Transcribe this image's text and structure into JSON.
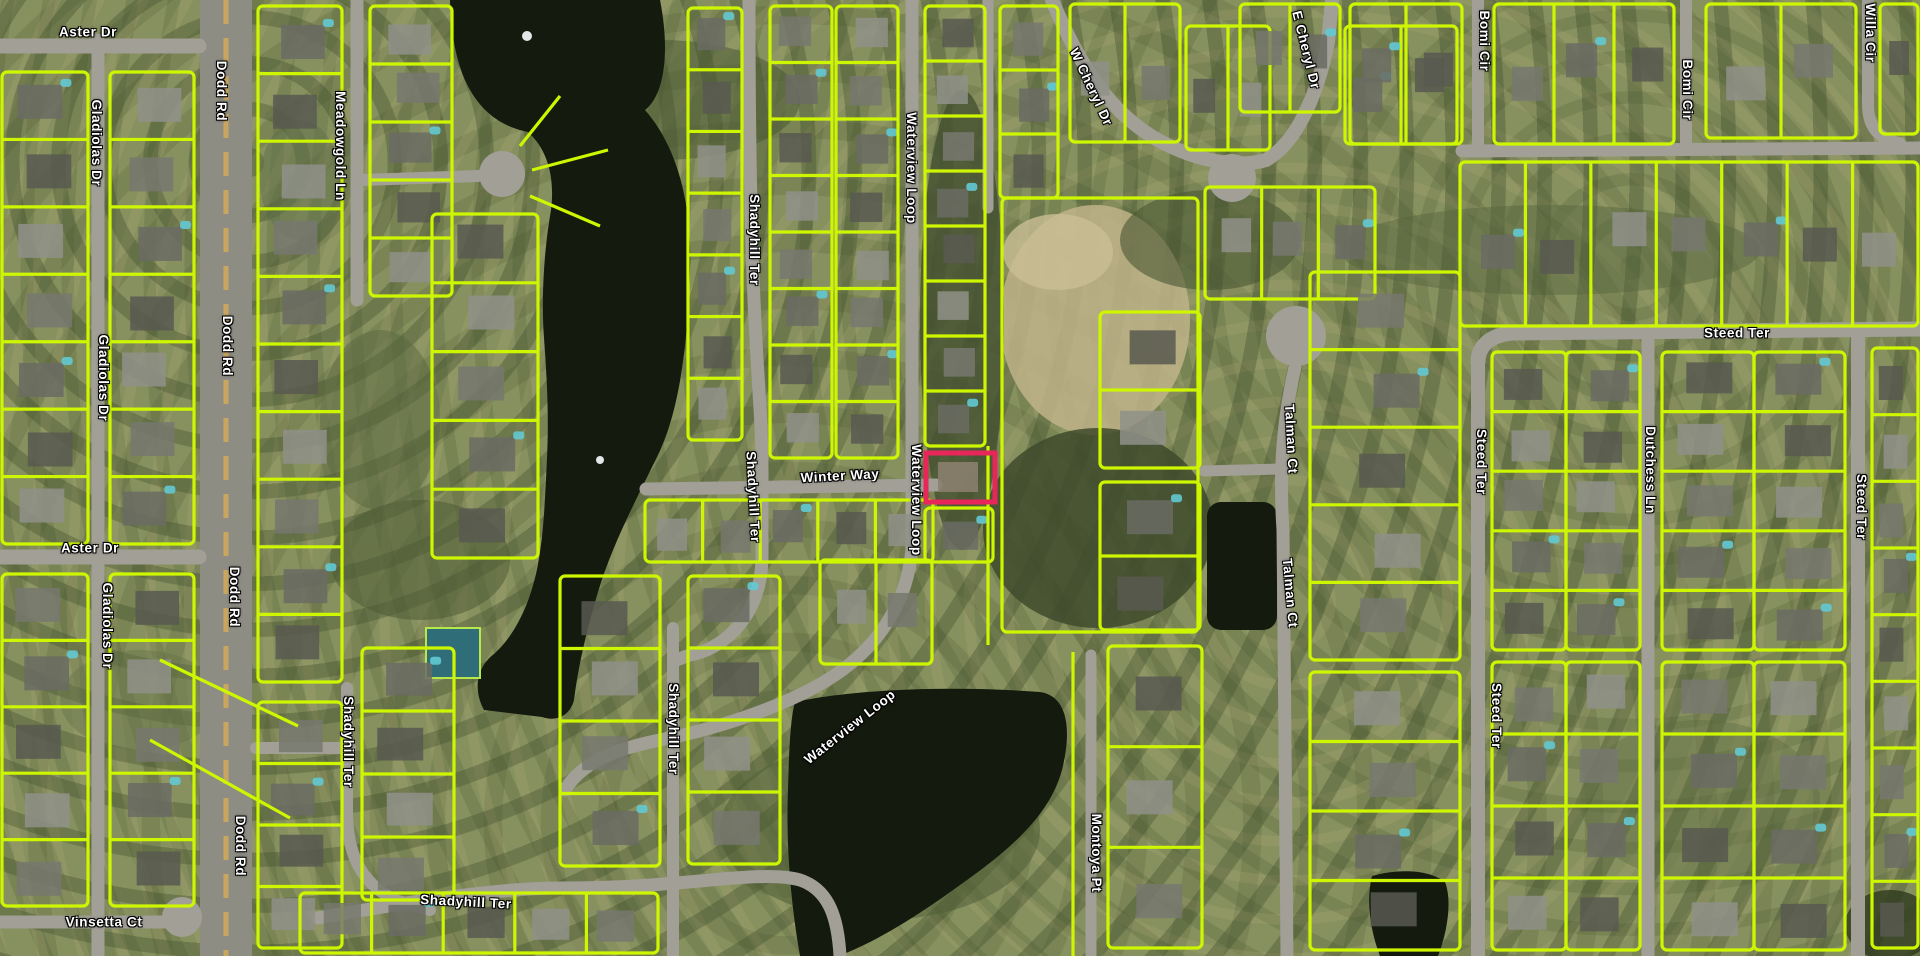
{
  "app": {
    "type": "gis-parcel-map-viewer",
    "view": "aerial-with-parcels"
  },
  "map": {
    "width": 1920,
    "height": 956,
    "colors": {
      "parcel_line": "#cdf600",
      "highlight": "#e8265a",
      "label_text": "#ffffff",
      "label_halo": "#000000",
      "road": "#a19f96",
      "road_major": "#8e8d84",
      "road_median": "#c9a660",
      "water": "#141a0e",
      "ground": "#87915f",
      "tennis_court": "#2f6e78",
      "fountain": "#eef2f2"
    },
    "highlight_parcel": {
      "x": 926,
      "y": 453,
      "w": 69,
      "h": 49,
      "stroke_width": 5
    },
    "street_labels": [
      {
        "t": "Aster Dr",
        "x": 88,
        "y": 32,
        "r": 0
      },
      {
        "t": "Gladiolas Dr",
        "x": 96,
        "y": 143,
        "r": 90
      },
      {
        "t": "Dodd Rd",
        "x": 221,
        "y": 91,
        "r": 90
      },
      {
        "t": "Meadowgold Ln",
        "x": 340,
        "y": 146,
        "r": 90
      },
      {
        "t": "Shadyhill Ter",
        "x": 754,
        "y": 240,
        "r": 90
      },
      {
        "t": "Waterview Loop",
        "x": 911,
        "y": 168,
        "r": 90
      },
      {
        "t": "W Cheryl Dr",
        "x": 1091,
        "y": 87,
        "r": 65
      },
      {
        "t": "E Cheryl Dr",
        "x": 1306,
        "y": 50,
        "r": 76
      },
      {
        "t": "Bomi Cir",
        "x": 1484,
        "y": 41,
        "r": 90
      },
      {
        "t": "Bomi Cir",
        "x": 1687,
        "y": 90,
        "r": 90
      },
      {
        "t": "Willa Cir",
        "x": 1870,
        "y": 33,
        "r": 90
      },
      {
        "t": "Steed Ter",
        "x": 1737,
        "y": 333,
        "r": 0
      },
      {
        "t": "Steed Ter",
        "x": 1481,
        "y": 462,
        "r": 90
      },
      {
        "t": "Dutchess Ln",
        "x": 1650,
        "y": 470,
        "r": 90
      },
      {
        "t": "Steed Ter",
        "x": 1861,
        "y": 507,
        "r": 90
      },
      {
        "t": "Winter Way",
        "x": 840,
        "y": 476,
        "r": -3
      },
      {
        "t": "Waterview Loop",
        "x": 916,
        "y": 500,
        "r": 90
      },
      {
        "t": "Shadyhill Ter",
        "x": 753,
        "y": 497,
        "r": 87
      },
      {
        "t": "Shadyhill Ter",
        "x": 673,
        "y": 729,
        "r": 90
      },
      {
        "t": "Shadyhill Ter",
        "x": 466,
        "y": 902,
        "r": 3
      },
      {
        "t": "Vinsetta Ct",
        "x": 104,
        "y": 922,
        "r": 0
      },
      {
        "t": "Dodd Rd",
        "x": 227,
        "y": 346,
        "r": 90
      },
      {
        "t": "Dodd Rd",
        "x": 234,
        "y": 597,
        "r": 90
      },
      {
        "t": "Dodd Rd",
        "x": 240,
        "y": 846,
        "r": 90
      },
      {
        "t": "Gladiolas Dr",
        "x": 103,
        "y": 378,
        "r": 90
      },
      {
        "t": "Gladiolas Dr",
        "x": 107,
        "y": 626,
        "r": 90
      },
      {
        "t": "Aster Dr",
        "x": 90,
        "y": 548,
        "r": 0
      },
      {
        "t": "Waterview Loop",
        "x": 850,
        "y": 727,
        "r": -38
      },
      {
        "t": "Montoya Pt",
        "x": 1096,
        "y": 853,
        "r": 90
      },
      {
        "t": "Talman Ct",
        "x": 1291,
        "y": 439,
        "r": 87
      },
      {
        "t": "Talman Ct",
        "x": 1290,
        "y": 593,
        "r": 85
      },
      {
        "t": "Steed Ter",
        "x": 1496,
        "y": 716,
        "r": 90
      },
      {
        "t": "Shadyhill Ter",
        "x": 348,
        "y": 742,
        "r": 90
      }
    ],
    "roads": [
      {
        "name": "dodd-rd",
        "d": "M226,0 L226,956",
        "w": 52,
        "major": true
      },
      {
        "name": "gladiolas-dr",
        "d": "M98,40 L98,956",
        "w": 13
      },
      {
        "name": "aster-dr-top",
        "d": "M0,46 L199,46",
        "w": 15
      },
      {
        "name": "aster-dr-mid",
        "d": "M0,557 L199,557",
        "w": 15
      },
      {
        "name": "vinsetta-ct",
        "d": "M0,922 L172,922",
        "w": 13
      },
      {
        "name": "meadowgold-ln",
        "d": "M357,0 L357,300",
        "w": 13
      },
      {
        "name": "meadowgold-spur",
        "d": "M362,180 L478,176",
        "w": 12
      },
      {
        "name": "shadyhill-ter-upper",
        "d": "M749,0 C749,350 762,380 762,470 L762,560 C760,620 720,650 690,655 L676,660",
        "w": 13
      },
      {
        "name": "shadyhill-ter-bottom-v",
        "d": "M673,628 L673,956",
        "w": 12
      },
      {
        "name": "shadyhill-ter-bottom-h",
        "d": "M318,918 C420,900 500,888 560,888 C620,888 650,885 675,883 C720,880 770,872 800,880 C830,890 838,920 840,956",
        "w": 13
      },
      {
        "name": "shadyhill-ter-east",
        "d": "M347,688 L347,810 C347,860 365,885 395,900 L430,910",
        "w": 12
      },
      {
        "name": "dodd-cross-east",
        "d": "M256,748 L350,748",
        "w": 12
      },
      {
        "name": "waterview-loop-top",
        "d": "M912,0 L912,548",
        "w": 13
      },
      {
        "name": "waterview-loop-arc",
        "d": "M912,548 C908,600 880,645 835,675 C790,705 720,728 660,740 C610,750 580,765 565,790",
        "w": 13
      },
      {
        "name": "winter-way",
        "d": "M646,489 L936,485",
        "w": 13
      },
      {
        "name": "w-cheryl-dr",
        "d": "M1052,0 C1078,62 1108,112 1158,140 C1198,162 1238,168 1266,160",
        "w": 14
      },
      {
        "name": "e-cheryl-dr",
        "d": "M1266,160 C1298,142 1318,92 1328,42 L1332,0",
        "w": 14
      },
      {
        "name": "steed-ter-h",
        "d": "M1478,362 C1478,345 1492,334 1515,333 L1920,329",
        "w": 15
      },
      {
        "name": "steed-ter-v",
        "d": "M1478,362 L1478,956",
        "w": 14
      },
      {
        "name": "dutchess-ln",
        "d": "M1648,341 L1648,956",
        "w": 13
      },
      {
        "name": "steed-ter-right",
        "d": "M1858,331 L1858,956",
        "w": 14
      },
      {
        "name": "bomi-cir-h",
        "d": "M1462,151 L1920,148",
        "w": 13
      },
      {
        "name": "bomi-cir-v1",
        "d": "M1478,0 L1478,145",
        "w": 12
      },
      {
        "name": "bomi-cir-v2",
        "d": "M1686,0 L1686,145",
        "w": 12
      },
      {
        "name": "willa-cir",
        "d": "M1868,0 L1868,105 C1868,128 1880,140 1900,143",
        "w": 12
      },
      {
        "name": "talman-ct",
        "d": "M1295,367 C1283,420 1279,470 1283,530 L1287,956",
        "w": 13
      },
      {
        "name": "talman-ct-spur",
        "d": "M1204,471 L1281,469",
        "w": 11
      },
      {
        "name": "montoya-pt",
        "d": "M1091,655 L1091,956",
        "w": 11
      },
      {
        "name": "north-street",
        "d": "M988,0 L988,208",
        "w": 11
      }
    ],
    "culdesac_bulbs": [
      {
        "cx": 182,
        "cy": 917,
        "r": 20
      },
      {
        "cx": 502,
        "cy": 174,
        "r": 23
      },
      {
        "cx": 1296,
        "cy": 336,
        "r": 30
      },
      {
        "cx": 1232,
        "cy": 178,
        "r": 24
      }
    ],
    "water": [
      {
        "name": "lake",
        "d": "M450,0 L660,0 C670,50 665,95 645,110 C680,150 692,210 690,270 C688,340 680,410 658,455 C636,500 612,545 598,592 C586,632 578,668 574,700 C570,716 556,722 542,717 L484,710 C472,688 478,666 494,654 C514,636 528,608 536,574 C544,538 545,498 547,458 C549,418 547,378 544,338 C541,298 544,250 551,210 C555,178 548,150 528,132 C478,122 452,78 450,0 Z"
      },
      {
        "name": "pond-center",
        "d": "M795,702 C860,688 960,686 1040,692 C1068,696 1072,730 1062,770 C1050,815 1010,850 960,885 C915,918 870,945 838,956 L800,956 C790,900 786,840 788,790 C789,755 790,720 795,702 Z"
      },
      {
        "name": "pond-bottom-right",
        "d": "M1372,876 C1400,868 1430,870 1445,882 C1452,900 1448,930 1438,956 L1380,956 C1370,930 1366,900 1372,876 Z"
      }
    ],
    "pond_rect": {
      "x": 1207,
      "y": 502,
      "w": 70,
      "h": 128,
      "rx": 14
    },
    "terrain_patches": [
      {
        "cx": 1095,
        "cy": 320,
        "rx": 95,
        "ry": 115,
        "f": "#c0b389",
        "o": 0.85
      },
      {
        "cx": 1058,
        "cy": 252,
        "rx": 55,
        "ry": 38,
        "f": "#cabe95",
        "o": 0.8
      },
      {
        "cx": 1098,
        "cy": 528,
        "rx": 115,
        "ry": 100,
        "f": "#3e4a2b",
        "o": 0.85
      },
      {
        "cx": 962,
        "cy": 320,
        "rx": 42,
        "ry": 230,
        "f": "#435030",
        "o": 0.8
      },
      {
        "cx": 1210,
        "cy": 240,
        "rx": 90,
        "ry": 50,
        "f": "#4a5732",
        "o": 0.6
      },
      {
        "cx": 660,
        "cy": 100,
        "rx": 140,
        "ry": 60,
        "f": "#46532f",
        "o": 0.5
      },
      {
        "cx": 420,
        "cy": 560,
        "rx": 90,
        "ry": 60,
        "f": "#4e5b34",
        "o": 0.55
      },
      {
        "cx": 880,
        "cy": 830,
        "rx": 160,
        "ry": 90,
        "f": "#515f37",
        "o": 0.55
      },
      {
        "cx": 1550,
        "cy": 250,
        "rx": 210,
        "ry": 45,
        "f": "#55633c",
        "o": 0.45
      },
      {
        "cx": 380,
        "cy": 420,
        "rx": 60,
        "ry": 90,
        "f": "#5a6840",
        "o": 0.5
      },
      {
        "cx": 1890,
        "cy": 925,
        "rx": 45,
        "ry": 35,
        "f": "#2e3a1e",
        "o": 0.8
      },
      {
        "cx": 300,
        "cy": 180,
        "rx": 40,
        "ry": 60,
        "f": "#60704a",
        "o": 0.5
      },
      {
        "cx": 1700,
        "cy": 800,
        "rx": 120,
        "ry": 80,
        "f": "#5d6b41",
        "o": 0.4
      },
      {
        "cx": 140,
        "cy": 700,
        "rx": 80,
        "ry": 50,
        "f": "#66744a",
        "o": 0.45
      }
    ],
    "parcel_strips": [
      {
        "x": 2,
        "y": 72,
        "w": 86,
        "h": 472,
        "n": 7,
        "dir": "h"
      },
      {
        "x": 2,
        "y": 574,
        "w": 86,
        "h": 332,
        "n": 5,
        "dir": "h"
      },
      {
        "x": 110,
        "y": 72,
        "w": 84,
        "h": 472,
        "n": 7,
        "dir": "h"
      },
      {
        "x": 110,
        "y": 574,
        "w": 84,
        "h": 332,
        "n": 5,
        "dir": "h"
      },
      {
        "x": 258,
        "y": 6,
        "w": 84,
        "h": 676,
        "n": 10,
        "dir": "h"
      },
      {
        "x": 258,
        "y": 702,
        "w": 84,
        "h": 246,
        "n": 4,
        "dir": "h"
      },
      {
        "x": 370,
        "y": 6,
        "w": 82,
        "h": 290,
        "n": 5,
        "dir": "h"
      },
      {
        "x": 432,
        "y": 214,
        "w": 106,
        "h": 344,
        "n": 5,
        "dir": "h"
      },
      {
        "x": 688,
        "y": 8,
        "w": 54,
        "h": 432,
        "n": 7,
        "dir": "h"
      },
      {
        "x": 770,
        "y": 6,
        "w": 62,
        "h": 452,
        "n": 8,
        "dir": "h"
      },
      {
        "x": 836,
        "y": 6,
        "w": 62,
        "h": 452,
        "n": 8,
        "dir": "h"
      },
      {
        "x": 925,
        "y": 6,
        "w": 60,
        "h": 440,
        "n": 8,
        "dir": "h"
      },
      {
        "x": 925,
        "y": 508,
        "w": 68,
        "h": 54,
        "n": 1,
        "dir": "h"
      },
      {
        "x": 1002,
        "y": 198,
        "w": 196,
        "h": 434,
        "n": 1,
        "dir": "h",
        "nh": 1
      },
      {
        "x": 645,
        "y": 500,
        "w": 288,
        "h": 62,
        "n": 5,
        "dir": "v"
      },
      {
        "x": 560,
        "y": 576,
        "w": 100,
        "h": 290,
        "n": 4,
        "dir": "h"
      },
      {
        "x": 688,
        "y": 576,
        "w": 92,
        "h": 288,
        "n": 4,
        "dir": "h"
      },
      {
        "x": 300,
        "y": 893,
        "w": 358,
        "h": 60,
        "n": 5,
        "dir": "v"
      },
      {
        "x": 820,
        "y": 560,
        "w": 112,
        "h": 104,
        "n": 2,
        "dir": "v"
      },
      {
        "x": 1108,
        "y": 646,
        "w": 94,
        "h": 302,
        "n": 3,
        "dir": "h"
      },
      {
        "x": 362,
        "y": 648,
        "w": 92,
        "h": 252,
        "n": 4,
        "dir": "h"
      },
      {
        "x": 1000,
        "y": 6,
        "w": 58,
        "h": 192,
        "n": 3,
        "dir": "h"
      },
      {
        "x": 1070,
        "y": 4,
        "w": 110,
        "h": 138,
        "n": 2,
        "dir": "v"
      },
      {
        "x": 1186,
        "y": 26,
        "w": 84,
        "h": 124,
        "n": 2,
        "dir": "v"
      },
      {
        "x": 1345,
        "y": 26,
        "w": 112,
        "h": 118,
        "n": 2,
        "dir": "v"
      },
      {
        "x": 1240,
        "y": 4,
        "w": 100,
        "h": 108,
        "n": 2,
        "dir": "v"
      },
      {
        "x": 1205,
        "y": 187,
        "w": 170,
        "h": 112,
        "n": 3,
        "dir": "v"
      },
      {
        "x": 1100,
        "y": 312,
        "w": 100,
        "h": 156,
        "n": 2,
        "dir": "h"
      },
      {
        "x": 1100,
        "y": 482,
        "w": 100,
        "h": 148,
        "n": 2,
        "dir": "h"
      },
      {
        "x": 1310,
        "y": 272,
        "w": 150,
        "h": 388,
        "n": 5,
        "dir": "h"
      },
      {
        "x": 1310,
        "y": 672,
        "w": 150,
        "h": 278,
        "n": 4,
        "dir": "h"
      },
      {
        "x": 1492,
        "y": 352,
        "w": 74,
        "h": 298,
        "n": 5,
        "dir": "h"
      },
      {
        "x": 1566,
        "y": 352,
        "w": 74,
        "h": 298,
        "n": 5,
        "dir": "h"
      },
      {
        "x": 1492,
        "y": 662,
        "w": 74,
        "h": 288,
        "n": 4,
        "dir": "h"
      },
      {
        "x": 1566,
        "y": 662,
        "w": 74,
        "h": 288,
        "n": 4,
        "dir": "h"
      },
      {
        "x": 1662,
        "y": 352,
        "w": 92,
        "h": 298,
        "n": 5,
        "dir": "h"
      },
      {
        "x": 1754,
        "y": 352,
        "w": 91,
        "h": 298,
        "n": 5,
        "dir": "h"
      },
      {
        "x": 1662,
        "y": 662,
        "w": 92,
        "h": 288,
        "n": 4,
        "dir": "h"
      },
      {
        "x": 1754,
        "y": 662,
        "w": 91,
        "h": 288,
        "n": 4,
        "dir": "h"
      },
      {
        "x": 1872,
        "y": 348,
        "w": 46,
        "h": 600,
        "n": 9,
        "dir": "h"
      },
      {
        "x": 1460,
        "y": 162,
        "w": 458,
        "h": 164,
        "n": 7,
        "dir": "v"
      },
      {
        "x": 1494,
        "y": 4,
        "w": 180,
        "h": 140,
        "n": 3,
        "dir": "v"
      },
      {
        "x": 1706,
        "y": 4,
        "w": 150,
        "h": 134,
        "n": 2,
        "dir": "v"
      },
      {
        "x": 1880,
        "y": 4,
        "w": 38,
        "h": 130,
        "n": 1,
        "dir": "v"
      },
      {
        "x": 1350,
        "y": 4,
        "w": 112,
        "h": 140,
        "n": 2,
        "dir": "v"
      }
    ],
    "parcel_lines": [
      {
        "d": "M988,446 L988,645"
      },
      {
        "d": "M1073,652 L1073,956"
      },
      {
        "d": "M160,660 L298,726"
      },
      {
        "d": "M150,740 L290,818"
      },
      {
        "d": "M520,146 L560,96"
      },
      {
        "d": "M532,170 L608,150"
      },
      {
        "d": "M530,196 L600,226"
      }
    ],
    "features": {
      "tennis_court": {
        "x": 426,
        "y": 628,
        "w": 54,
        "h": 50
      },
      "fountains": [
        {
          "cx": 527,
          "cy": 36,
          "r": 5
        },
        {
          "cx": 600,
          "cy": 460,
          "r": 4
        }
      ],
      "highlight_house": {
        "x": 938,
        "y": 462,
        "w": 40,
        "h": 30,
        "f": "#8a7f6e"
      }
    }
  }
}
